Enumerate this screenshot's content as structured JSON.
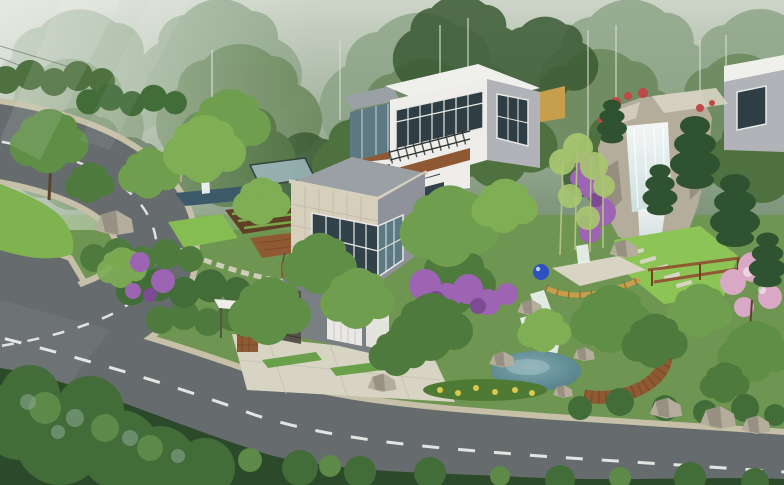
{
  "scene": {
    "type": "architectural-rendering",
    "description": "Aerial 3D rendering of modern hillside villas with landscaped gardens, a rock waterfall, a pond and a curving asphalt road, backed by misty forest",
    "regions": [
      {
        "name": "misty-forest",
        "label": "Misty hillside forest"
      },
      {
        "name": "hairpin-road",
        "label": "Curving asphalt road with lane dashes"
      },
      {
        "name": "roadside-lawn",
        "label": "Roadside lawn inside the hairpin"
      },
      {
        "name": "left-garden",
        "label": "Kitchen garden with reflecting pool and pergola"
      },
      {
        "name": "main-villa",
        "label": "Stone-clad modern villa with corner glazing"
      },
      {
        "name": "upper-villa",
        "label": "White flat-roof villa with balcony"
      },
      {
        "name": "neighbor-villa",
        "label": "Neighboring villa at right edge"
      },
      {
        "name": "entrance",
        "label": "Gate canopy, stone pillar, garage and driveway"
      },
      {
        "name": "rock-waterfall",
        "label": "Rock waterfall with bougainvillea"
      },
      {
        "name": "waterfall-garden",
        "label": "Waterfall lawn with stepping stones and pergola"
      },
      {
        "name": "garden-terrace",
        "label": "Fenced garden terrace with blue ornament"
      },
      {
        "name": "pond",
        "label": "Landscape pond with curved wooden deck"
      },
      {
        "name": "flowering-trees",
        "label": "Purple and pink flowering trees"
      },
      {
        "name": "bottom-hedge",
        "label": "Foreground tree canopies along the road"
      }
    ]
  },
  "colors": {
    "mistTop": "#cdd5c8",
    "mistBottom": "#7e957a",
    "forestFar": "#8ba385",
    "forestMid": "#6d8a5f",
    "forestNear": "#4e713f",
    "forestDeep": "#3a5a33",
    "birchTrunk": "#d8ded2",
    "baseGreen": "#6f9553",
    "lawnBright": "#86bd52",
    "lawnMid": "#7fb34f",
    "lawnWaterfall": "#8cc455",
    "plantingBed": "#4f7a33",
    "asphalt": "#666c6e",
    "curb": "#c6c0a8",
    "laneMarking": "#eef0ec",
    "paver": "#d8d4c3",
    "grassStrip": "#6aa04a",
    "whiteWall": "#eeede9",
    "whiteRoof": "#eff0ec",
    "grayFaceLight": "#b2b3b9",
    "grayFace": "#8f929b",
    "grayFaceDark": "#7a7f83",
    "annexRoof": "#9aa0a3",
    "stoneTile": "#d6cfbc",
    "stoneTileGrid": "#b9b2a0",
    "glassDark": "#2f3e44",
    "glassMid": "#31424a",
    "glassLight": "#5d7a84",
    "glassPale": "#9fb9bf",
    "mullion": "#e8e8e4",
    "railing": "#26302e",
    "wood": "#8f5a33",
    "woodDark": "#6e4426",
    "stonePillar": "#56514a",
    "garageDoor": "#e9e8e4",
    "rock": "#b5ad9c",
    "rockShadow": "#8e8778",
    "rockLight": "#d2cbbb",
    "waterWhite": "#f6fafa",
    "waterBlue": "#cfe2e4",
    "poolSlate": "#3d5a6a",
    "pondDeep": "#4a7782",
    "pondLight": "#7fa8ae",
    "purpleBloom": "#9c64b2",
    "purpleDeep": "#7c4b92",
    "pinkBloom": "#d9a8c4",
    "redBloom": "#bf4848",
    "yellowBloom": "#d9c94e",
    "fenceYellow": "#c79f4c",
    "blueOrnament": "#2d52c0",
    "soil": "#5f4026",
    "shrubDark": "#2c4a2a",
    "shrubMid": "#426c38",
    "shrubLight": "#5d8a49",
    "shrubMisty": "#8fa898",
    "treeGreenDark": "#4e7b3d",
    "treeGreen": "#5f8f47",
    "treeGreenMid": "#6f9e4e",
    "treeGreenLight": "#7fae55",
    "pineDark": "#2f5230",
    "bamboo": "#a9c770",
    "bambooStalk": "#b8c98a",
    "trunk": "#5a4330"
  }
}
